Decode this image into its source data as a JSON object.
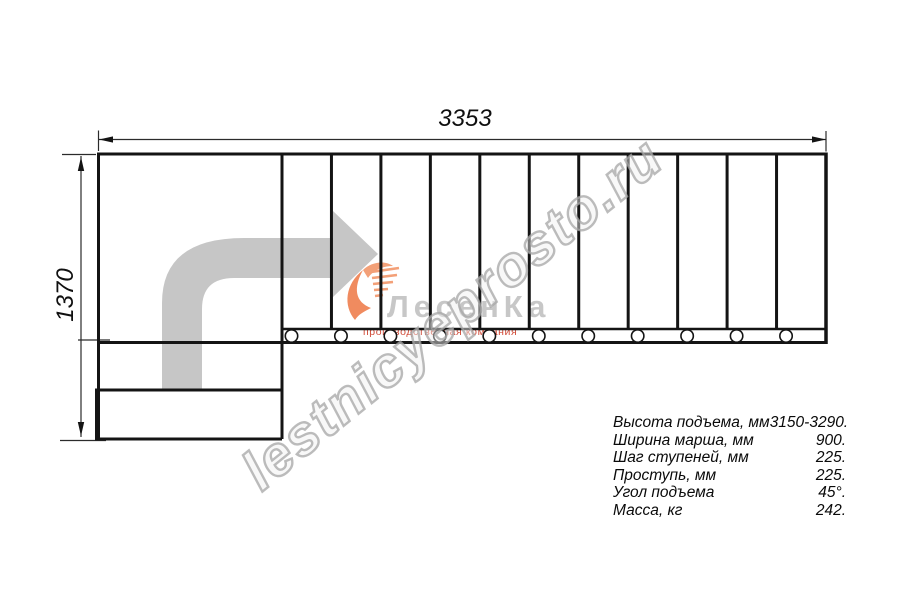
{
  "drawing": {
    "top_dimension": "3353",
    "left_dimension": "1370",
    "tread_count": 11,
    "arrow_direction": "up-then-right"
  },
  "specs": {
    "rows": [
      {
        "label": "Высота подъема, мм",
        "value": "3150-3290."
      },
      {
        "label": "Ширина марша, мм",
        "value": "900."
      },
      {
        "label": "Шаг ступеней, мм",
        "value": "225."
      },
      {
        "label": "Проступь, мм",
        "value": "225."
      },
      {
        "label": "Угол подъема",
        "value": "45°."
      },
      {
        "label": "Масса, кг",
        "value": "242."
      }
    ]
  },
  "logo": {
    "name": "ЛесенКа",
    "tagline": "производственная компания"
  },
  "watermark": {
    "text": "lestnicyeprosto.ru"
  },
  "colors": {
    "line_black": "#141414",
    "flow_arrow_grey": "#c6c6c6",
    "logo_orange": "#f08b5f",
    "tagline_red": "#d14b38",
    "watermark_grey": "#a6a6a6"
  }
}
